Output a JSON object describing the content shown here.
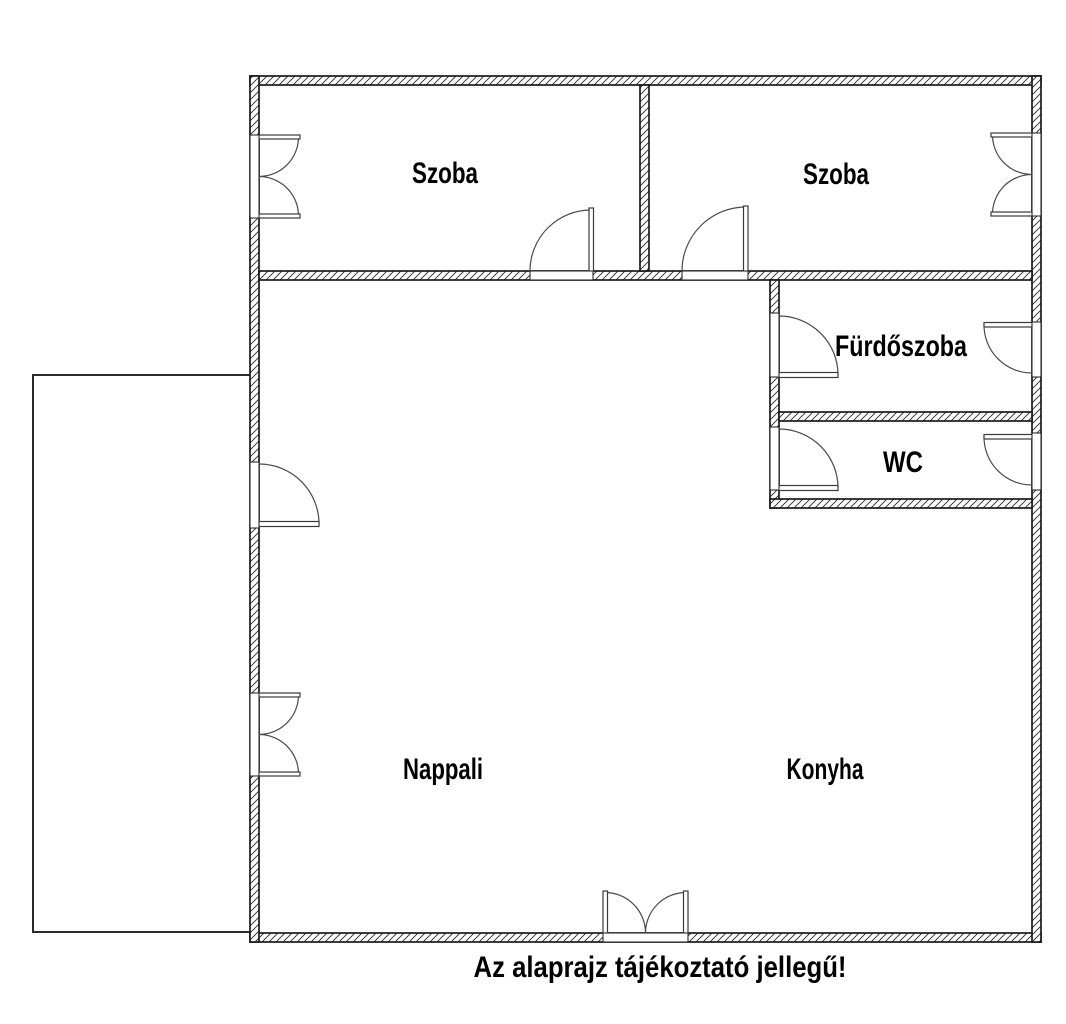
{
  "colors": {
    "line": "#000000",
    "background": "#ffffff"
  },
  "floorplan": {
    "rooms": [
      {
        "id": "szoba-1",
        "label": "Szoba"
      },
      {
        "id": "szoba-2",
        "label": "Szoba"
      },
      {
        "id": "furdoszoba",
        "label": "Fürdőszoba"
      },
      {
        "id": "wc",
        "label": "WC"
      },
      {
        "id": "nappali",
        "label": "Nappali"
      },
      {
        "id": "konyha",
        "label": "Konyha"
      }
    ],
    "caption": "Az alaprajz tájékoztató jellegű!"
  }
}
